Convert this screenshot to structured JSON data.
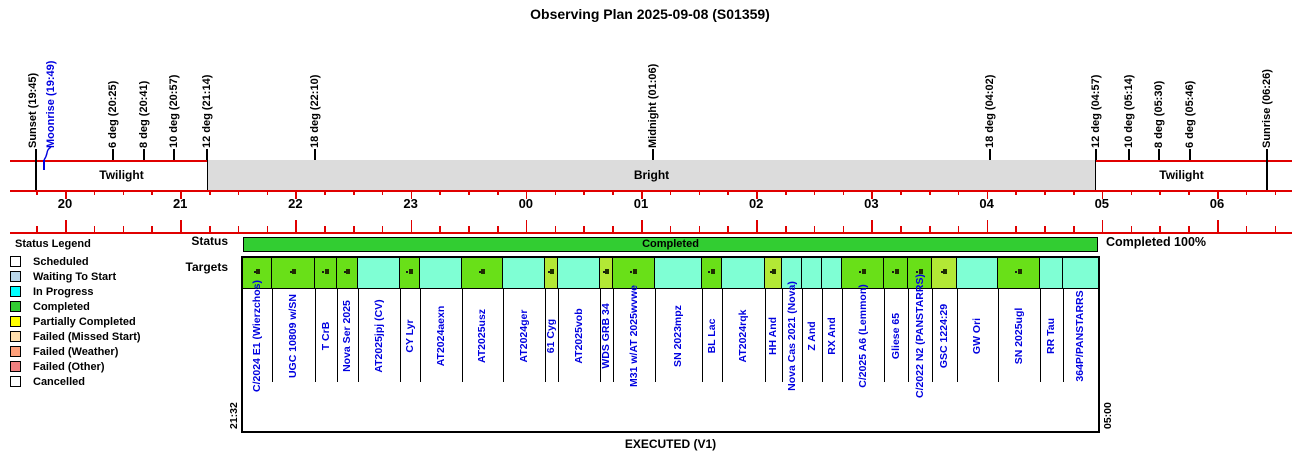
{
  "title": "Observing Plan 2025-09-08 (S01359)",
  "colors": {
    "axis_red": "#E00000",
    "label_blue": "#0000E0",
    "bright_gray": "#DCDCDC",
    "status_bar_green": "#32CD32",
    "cell_green": "#69E018",
    "cell_greenyellow": "#B2E835",
    "cell_cyan": "#7FFFD4"
  },
  "bands": {
    "twilight_left": "Twilight",
    "bright": "Bright",
    "twilight_right": "Twilight"
  },
  "sky_markers": [
    {
      "label": "Sunset (19:45)",
      "time": "19:45",
      "min": 1185,
      "color": "#000000",
      "tick": "band",
      "dx": -3
    },
    {
      "label": "Moonrise (19:49)",
      "time": "19:49",
      "min": 1189,
      "color": "#0000E0",
      "tick": "moon",
      "dx": 7
    },
    {
      "label": "6 deg (20:25)",
      "time": "20:25",
      "min": 1225,
      "color": "#000000",
      "tick": "short",
      "dx": 0
    },
    {
      "label": "8 deg (20:41)",
      "time": "20:41",
      "min": 1241,
      "color": "#000000",
      "tick": "short",
      "dx": 0
    },
    {
      "label": "10 deg (20:57)",
      "time": "20:57",
      "min": 1257,
      "color": "#000000",
      "tick": "short",
      "dx": 0
    },
    {
      "label": "12 deg (21:14)",
      "time": "21:14",
      "min": 1274,
      "color": "#000000",
      "tick": "short",
      "dx": 0
    },
    {
      "label": "18 deg (22:10)",
      "time": "22:10",
      "min": 1330,
      "color": "#000000",
      "tick": "short",
      "dx": 0
    },
    {
      "label": "Midnight (01:06)",
      "time": "01:06",
      "min": 1506,
      "color": "#000000",
      "tick": "short",
      "dx": 0
    },
    {
      "label": "18 deg (04:02)",
      "time": "04:02",
      "min": 1682,
      "color": "#000000",
      "tick": "short",
      "dx": 0
    },
    {
      "label": "12 deg (04:57)",
      "time": "04:57",
      "min": 1737,
      "color": "#000000",
      "tick": "short",
      "dx": 0
    },
    {
      "label": "10 deg (05:14)",
      "time": "05:14",
      "min": 1754,
      "color": "#000000",
      "tick": "short",
      "dx": 0
    },
    {
      "label": "8 deg (05:30)",
      "time": "05:30",
      "min": 1770,
      "color": "#000000",
      "tick": "short",
      "dx": 0
    },
    {
      "label": "6 deg (05:46)",
      "time": "05:46",
      "min": 1786,
      "color": "#000000",
      "tick": "short",
      "dx": 0
    },
    {
      "label": "Sunrise (06:26)",
      "time": "06:26",
      "min": 1826,
      "color": "#000000",
      "tick": "band",
      "dx": 0
    }
  ],
  "hours": [
    {
      "label": "20",
      "min": 1200
    },
    {
      "label": "21",
      "min": 1260
    },
    {
      "label": "22",
      "min": 1320
    },
    {
      "label": "23",
      "min": 1380
    },
    {
      "label": "00",
      "min": 1440
    },
    {
      "label": "01",
      "min": 1500
    },
    {
      "label": "02",
      "min": 1560
    },
    {
      "label": "03",
      "min": 1620
    },
    {
      "label": "04",
      "min": 1680
    },
    {
      "label": "05",
      "min": 1740
    },
    {
      "label": "06",
      "min": 1800
    }
  ],
  "legend": {
    "title": "Status Legend",
    "items": [
      {
        "label": "Scheduled",
        "color": "#FFFFFF"
      },
      {
        "label": "Waiting To Start",
        "color": "#B9D7EA"
      },
      {
        "label": "In Progress",
        "color": "#00FFFF"
      },
      {
        "label": "Completed",
        "color": "#32CD32"
      },
      {
        "label": "Partially Completed",
        "color": "#FFFF00"
      },
      {
        "label": "Failed (Missed Start)",
        "color": "#FFDEAD"
      },
      {
        "label": "Failed (Weather)",
        "color": "#FFA07A"
      },
      {
        "label": "Failed (Other)",
        "color": "#F08080"
      },
      {
        "label": "Cancelled",
        "color": "#FCFCFC"
      }
    ]
  },
  "status_row": {
    "label": "Status",
    "bar_text": "Completed",
    "summary": "Completed 100%"
  },
  "targets_row": {
    "label": "Targets"
  },
  "timeline": {
    "start_label": "21:32",
    "end_label": "05:00",
    "caption": "EXECUTED (V1)"
  },
  "chart_data": {
    "type": "timeline",
    "title": "Observing Plan 2025-09-08 (S01359)",
    "x_axis_hours": [
      "20",
      "21",
      "22",
      "23",
      "00",
      "01",
      "02",
      "03",
      "04",
      "05",
      "06"
    ],
    "night_events": [
      {
        "event": "Sunset",
        "time": "19:45"
      },
      {
        "event": "Moonrise",
        "time": "19:49"
      },
      {
        "event": "Sun -6 deg",
        "time": "20:25"
      },
      {
        "event": "Sun -8 deg",
        "time": "20:41"
      },
      {
        "event": "Sun -10 deg",
        "time": "20:57"
      },
      {
        "event": "Sun -12 deg",
        "time": "21:14"
      },
      {
        "event": "Sun -18 deg",
        "time": "22:10"
      },
      {
        "event": "Midnight",
        "time": "01:06"
      },
      {
        "event": "Sun -18 deg",
        "time": "04:02"
      },
      {
        "event": "Sun -12 deg",
        "time": "04:57"
      },
      {
        "event": "Sun -10 deg",
        "time": "05:14"
      },
      {
        "event": "Sun -8 deg",
        "time": "05:30"
      },
      {
        "event": "Sun -6 deg",
        "time": "05:46"
      },
      {
        "event": "Sunrise",
        "time": "06:26"
      }
    ],
    "bands": [
      {
        "label": "Twilight",
        "start": "19:45",
        "end": "21:14"
      },
      {
        "label": "Bright",
        "start": "21:14",
        "end": "04:57"
      },
      {
        "label": "Twilight",
        "start": "04:57",
        "end": "06:26"
      }
    ],
    "status_track": {
      "label": "Completed",
      "start": "21:32",
      "end": "05:00",
      "completion": "Completed 100%"
    },
    "targets": [
      {
        "name": "C/2024 E1 (Wierzchos)",
        "w": 29,
        "status": "green",
        "marker": true
      },
      {
        "name": "UGC 10809 w/SN",
        "w": 43,
        "status": "green",
        "marker": true
      },
      {
        "name": "T CrB",
        "w": 22,
        "status": "green",
        "marker": true
      },
      {
        "name": "Nova Ser 2025",
        "w": 21,
        "status": "green",
        "marker": true
      },
      {
        "name": "AT2025jpj (CV)",
        "w": 42,
        "status": "cyan",
        "marker": false
      },
      {
        "name": "CY Lyr",
        "w": 20,
        "status": "green",
        "marker": true
      },
      {
        "name": "AT2024aexn",
        "w": 42,
        "status": "cyan",
        "marker": false
      },
      {
        "name": "AT2025usz",
        "w": 41,
        "status": "green",
        "marker": true
      },
      {
        "name": "AT2024ger",
        "w": 42,
        "status": "cyan",
        "marker": false
      },
      {
        "name": "61 Cyg",
        "w": 13,
        "status": "greenyellow",
        "marker": true
      },
      {
        "name": "AT2025vob",
        "w": 42,
        "status": "cyan",
        "marker": false
      },
      {
        "name": "WDS GRB 34",
        "w": 13,
        "status": "greenyellow",
        "marker": true
      },
      {
        "name": "M31 w/AT 2025wvwe",
        "w": 42,
        "status": "green",
        "marker": true
      },
      {
        "name": "SN 2023mpz",
        "w": 47,
        "status": "cyan",
        "marker": false
      },
      {
        "name": "BL Lac",
        "w": 20,
        "status": "green",
        "marker": true
      },
      {
        "name": "AT2024rqk",
        "w": 43,
        "status": "cyan",
        "marker": false
      },
      {
        "name": "HH And",
        "w": 17,
        "status": "greenyellow",
        "marker": true
      },
      {
        "name": "Nova Cas 2021 (Nova)",
        "w": 20,
        "status": "cyan",
        "marker": false
      },
      {
        "name": "Z And",
        "w": 20,
        "status": "cyan",
        "marker": false
      },
      {
        "name": "RX And",
        "w": 20,
        "status": "cyan",
        "marker": false
      },
      {
        "name": "C/2025 A6 (Lemmon)",
        "w": 42,
        "status": "green",
        "marker": true
      },
      {
        "name": "Gliese 65",
        "w": 24,
        "status": "green",
        "marker": true
      },
      {
        "name": "C/2022 N2 (PANSTARRS)",
        "w": 24,
        "status": "green",
        "marker": true
      },
      {
        "name": "GSC 1224:29",
        "w": 25,
        "status": "greenyellow",
        "marker": true
      },
      {
        "name": "GW Ori",
        "w": 41,
        "status": "cyan",
        "marker": false
      },
      {
        "name": "SN 2025ugl",
        "w": 42,
        "status": "green",
        "marker": true
      },
      {
        "name": "RR Tau",
        "w": 23,
        "status": "cyan",
        "marker": false
      },
      {
        "name": "364P/PANSTARRS",
        "w": 35,
        "status": "cyan",
        "marker": false
      }
    ]
  }
}
